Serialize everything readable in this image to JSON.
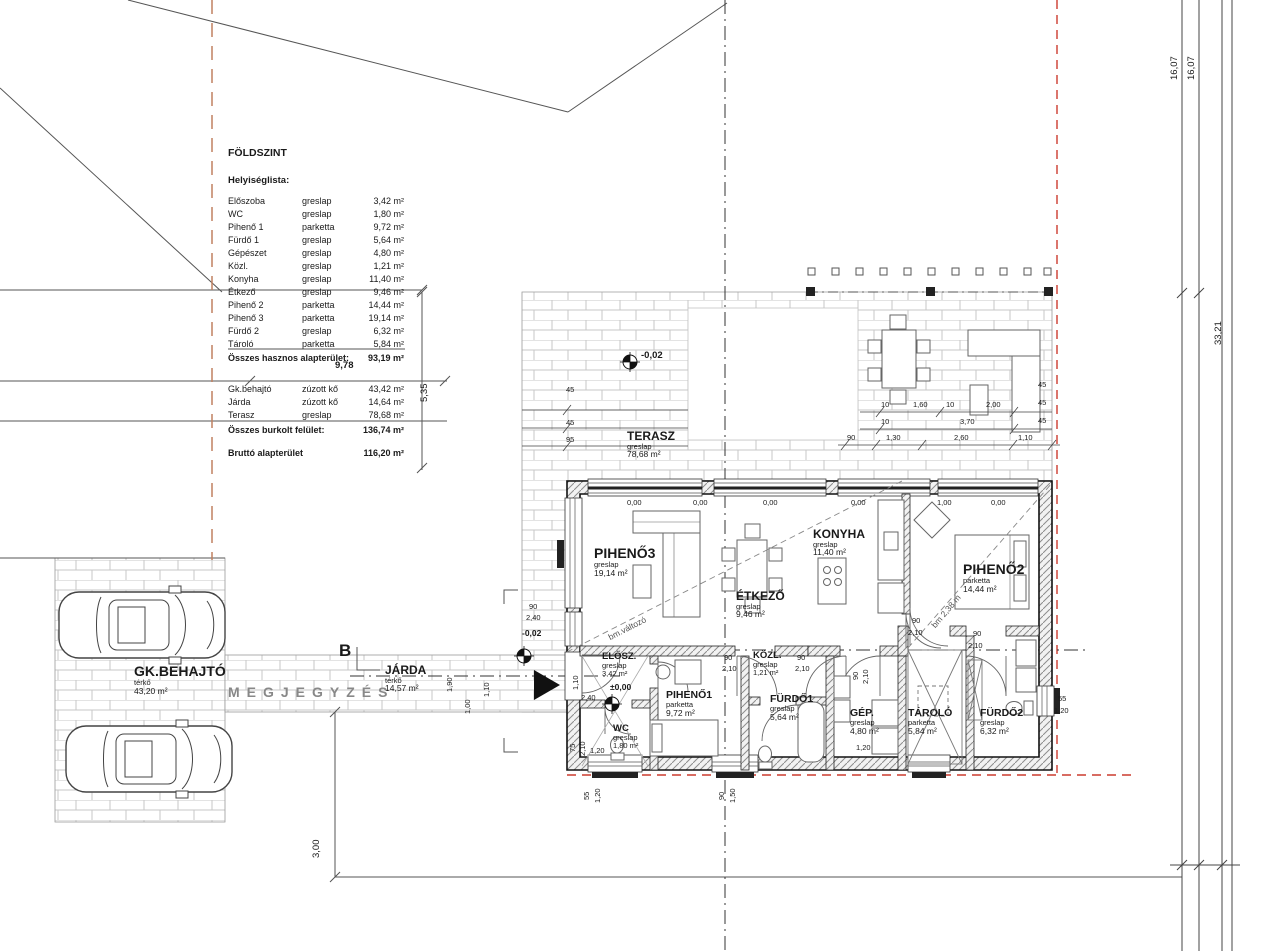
{
  "legend": {
    "title": "FÖLDSZINT",
    "subtitle": "Helyiséglista:",
    "rows": [
      {
        "name": "Előszoba",
        "finish": "greslap",
        "area": "3,42 m²"
      },
      {
        "name": "WC",
        "finish": "greslap",
        "area": "1,80 m²"
      },
      {
        "name": "Pihenő 1",
        "finish": "parketta",
        "area": "9,72 m²"
      },
      {
        "name": "Fürdő 1",
        "finish": "greslap",
        "area": "5,64 m²"
      },
      {
        "name": "Gépészet",
        "finish": "greslap",
        "area": "4,80 m²"
      },
      {
        "name": "Közl.",
        "finish": "greslap",
        "area": "1,21 m²"
      },
      {
        "name": "Konyha",
        "finish": "greslap",
        "area": "11,40 m²"
      },
      {
        "name": "Étkező",
        "finish": "greslap",
        "area": "9,46 m²"
      },
      {
        "name": "Pihenő 2",
        "finish": "parketta",
        "area": "14,44 m²"
      },
      {
        "name": "Pihenő 3",
        "finish": "parketta",
        "area": "19,14 m²"
      },
      {
        "name": "Fürdő 2",
        "finish": "greslap",
        "area": "6,32 m²"
      },
      {
        "name": "Tároló",
        "finish": "parketta",
        "area": "5,84 m²"
      }
    ],
    "total_label": "Összes hasznos alapterület:",
    "total_value": "93,19 m²",
    "ext_rows": [
      {
        "name": "Gk.behajtó",
        "finish": "zúzott kő",
        "area": "43,42 m²"
      },
      {
        "name": "Járda",
        "finish": "zúzott kő",
        "area": "14,64 m²"
      },
      {
        "name": "Terasz",
        "finish": "greslap",
        "area": "78,68 m²"
      }
    ],
    "ext_total_label": "Összes burkolt felület:",
    "ext_total_value": "136,74 m²",
    "gross_label": "Bruttó alapterület",
    "gross_value": "116,20 m²"
  },
  "rooms": {
    "terasz": {
      "name": "TERASZ",
      "finish": "greslap",
      "area": "78,68 m²"
    },
    "p3": {
      "name": "PIHENŐ3",
      "finish": "greslap",
      "area": "19,14 m²"
    },
    "etk": {
      "name": "ÉTKEZŐ",
      "finish": "greslap",
      "area": "9,46 m²"
    },
    "kony": {
      "name": "KONYHA",
      "finish": "greslap",
      "area": "11,40 m²"
    },
    "p2": {
      "name": "PIHENŐ2",
      "finish": "parketta",
      "area": "14,44 m²"
    },
    "elosz": {
      "name": "ELŐSZ.",
      "finish": "greslap",
      "area": "3,42 m²"
    },
    "p1": {
      "name": "PIHENŐ1",
      "finish": "parketta",
      "area": "9,72 m²"
    },
    "wc": {
      "name": "WC",
      "finish": "greslap",
      "area": "1,80 m²"
    },
    "kozl": {
      "name": "KÖZL.",
      "finish": "greslap",
      "area": "1,21 m²"
    },
    "f1": {
      "name": "FÜRDŐ1",
      "finish": "greslap",
      "area": "5,64 m²"
    },
    "gep": {
      "name": "GÉP.",
      "finish": "greslap",
      "area": "4,80 m²"
    },
    "tarolo": {
      "name": "TÁROLÓ",
      "finish": "parketta",
      "area": "5,84 m²"
    },
    "f2": {
      "name": "FÜRDŐ2",
      "finish": "greslap",
      "area": "6,32 m²"
    },
    "gk": {
      "name": "GK.BEHAJTÓ",
      "finish": "térkő",
      "area": "43,20 m²"
    },
    "jarda": {
      "name": "JÁRDA",
      "finish": "térkő",
      "area": "14,57 m²"
    }
  },
  "site": {
    "megjegyzes": "MEGJEGYZÉS",
    "section": "B"
  },
  "levels": {
    "terrace": "-0,02",
    "entry": "-0,02",
    "zero": "±0,00"
  },
  "notes": {
    "diag1": "bm.változó",
    "diag2": "bm 2,38 m"
  },
  "dims": {
    "right": [
      "16,07",
      "16,07",
      "33,21"
    ],
    "d978": "9,78",
    "d535": "5,35",
    "d300": "3,00",
    "terrace_left": [
      "45",
      "45",
      "95"
    ],
    "r1": [
      "10",
      "1,60",
      "10",
      "2,00"
    ],
    "r1r": [
      "45",
      "45",
      "45"
    ],
    "r2": [
      "10",
      "3,70"
    ],
    "r3": [
      "90",
      "1,30",
      "2,60",
      "1,10"
    ],
    "levels_row": [
      "0,00",
      "0,00",
      "0,00",
      "0,00",
      "1,00",
      "0,00"
    ],
    "left_window": [
      "90",
      "2,40"
    ],
    "entry_door": [
      "1,10",
      "2,40"
    ],
    "wc_door": [
      "75",
      "2,10"
    ],
    "wc_w": "1,20",
    "kozl_l": [
      "90",
      "2,10"
    ],
    "kozl_r": [
      "90",
      "2,10"
    ],
    "gep_door": [
      "90",
      "2,10"
    ],
    "gep_w": "1,20",
    "p2_door": [
      "90",
      "2,10"
    ],
    "f2_door": [
      "90",
      "2,10"
    ],
    "f2_win": [
      "55",
      "1,20"
    ],
    "bw1": [
      "55",
      "1,20"
    ],
    "bw2": [
      "90",
      "1,50"
    ],
    "jarda_w": [
      "1,90",
      "1,00",
      "1,10"
    ]
  }
}
